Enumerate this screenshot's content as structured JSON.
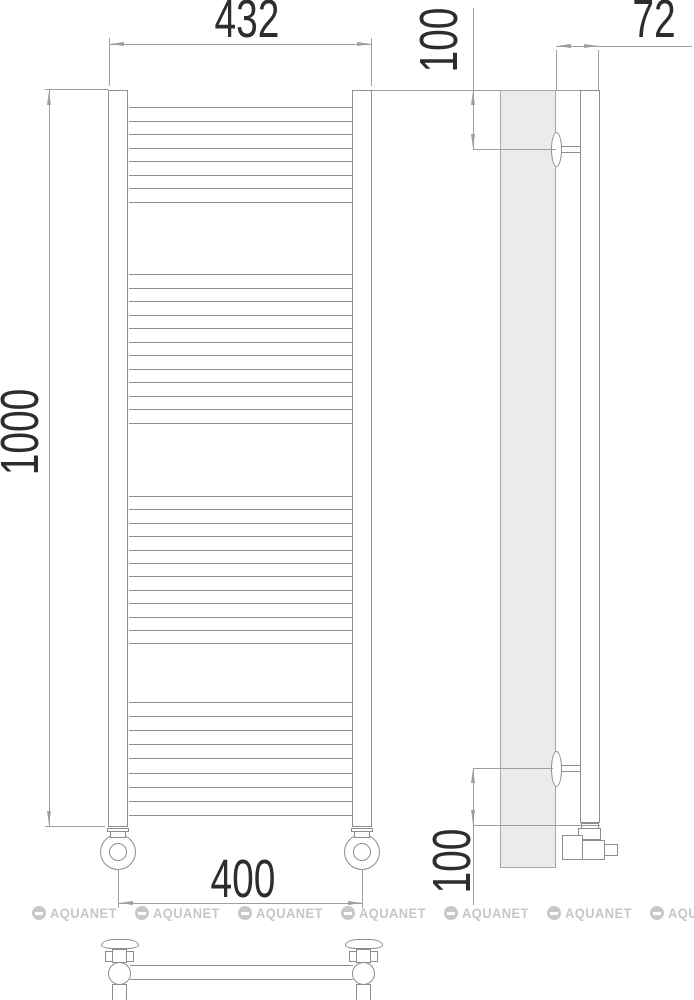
{
  "drawing": {
    "type": "technical-dimension-diagram",
    "dimensions": {
      "width_top": "432",
      "height": "1000",
      "bottom_pitch": "400",
      "depth": "72",
      "offset_top": "100",
      "offset_bottom": "100"
    },
    "front_view": {
      "rung_groups": [
        {
          "start_y": 107,
          "count": 8,
          "spacing": 13.5
        },
        {
          "start_y": 274,
          "count": 12,
          "spacing": 13.5
        },
        {
          "start_y": 496,
          "count": 12,
          "spacing": 13.4
        },
        {
          "start_y": 702,
          "count": 9,
          "spacing": 14.1
        }
      ]
    },
    "watermark": {
      "text": "AQUANET",
      "positions_x": [
        32,
        135,
        238,
        341,
        444,
        547,
        650
      ],
      "y": 905
    },
    "colors": {
      "drawing_line": "#8d8d8d",
      "dimension_line": "#9e9e9e",
      "dimension_text": "#2d2d2d",
      "wall_fill": "#ebebeb",
      "watermark": "#c8c8c8"
    }
  }
}
